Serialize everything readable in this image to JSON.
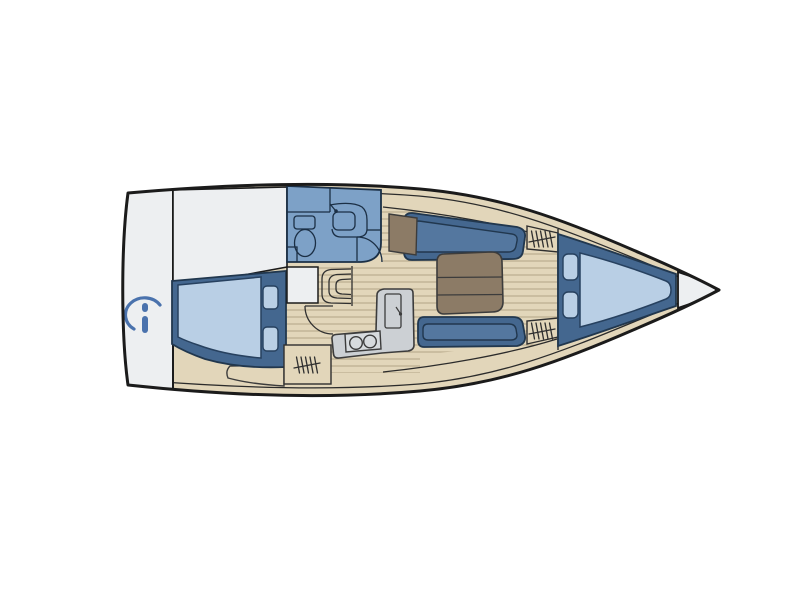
{
  "diagram": {
    "kind": "sailboat-interior-floor-plan",
    "orientation": "bow-right",
    "colors": {
      "background": "#ffffff",
      "hull_outline": "#1b1b1b",
      "deck_tan": "#e2d6ba",
      "deck_white": "#edeff1",
      "plank_line": "#b3a485",
      "berth_frame_blue": "#44678f",
      "cushion_inner_blue": "#54779f",
      "mattress_light_blue": "#b9cfe5",
      "head_blue": "#7da1c7",
      "galley_gray": "#ccd0d4",
      "stove_gray": "#d7dbde",
      "table_brown": "#8c7b66",
      "logo_blue": "#4a72ad"
    },
    "counts": {
      "aft_cabin_pillows": 2,
      "bow_cabin_pillows": 2,
      "stove_burners": 2,
      "storage_hatch_symbols": 3,
      "table_sections": 3,
      "companionway_steps": 3
    }
  }
}
